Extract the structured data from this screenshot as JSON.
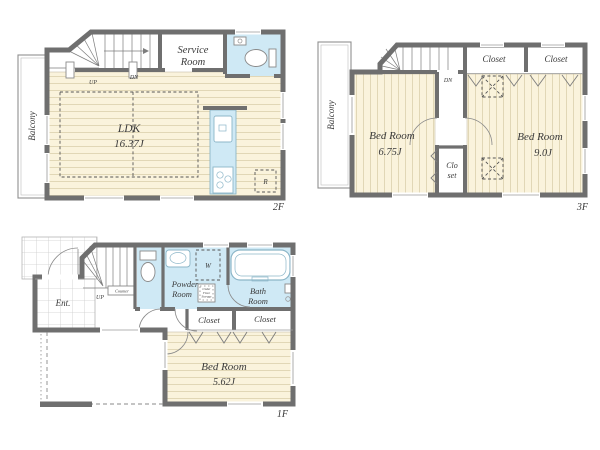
{
  "colors": {
    "bg": "#ffffff",
    "wall": "#6f6f6f",
    "floor": "#faf3dc",
    "floor_line": "#e1d7b6",
    "water": "#cfe9f5",
    "water_line": "#8cb6c8",
    "tile_line": "#cccccc",
    "text": "#3a3a3a",
    "outline": "#8f8f8f"
  },
  "floor2": {
    "label": "2F",
    "balcony": "Balcony",
    "stairs_up": "UP",
    "stairs_dn": "DN",
    "service_room": [
      "Service",
      "Room"
    ],
    "ldk": [
      "LDK",
      "16.37J"
    ],
    "fridge": "R"
  },
  "floor3": {
    "label": "3F",
    "balcony": "Balcony",
    "stairs_dn": "DN",
    "closet_left": "Closet",
    "closet_right": "Closet",
    "bedroom_left": [
      "Bed Room",
      "6.75J"
    ],
    "bedroom_right": [
      "Bed Room",
      "9.0J"
    ],
    "closet_mid": [
      "Clo",
      "set"
    ]
  },
  "floor1": {
    "label": "1F",
    "entrance": "Ent.",
    "stairs_up": "UP",
    "counter": "Counter",
    "powder_room": [
      "Powder",
      "Room"
    ],
    "washer": "W",
    "under_floor_storage": [
      "Under",
      "Floor",
      "Storage"
    ],
    "bath_room": [
      "Bath",
      "Room"
    ],
    "closet_left": "Closet",
    "closet_right": "Closet",
    "bedroom": [
      "Bed Room",
      "5.62J"
    ]
  }
}
